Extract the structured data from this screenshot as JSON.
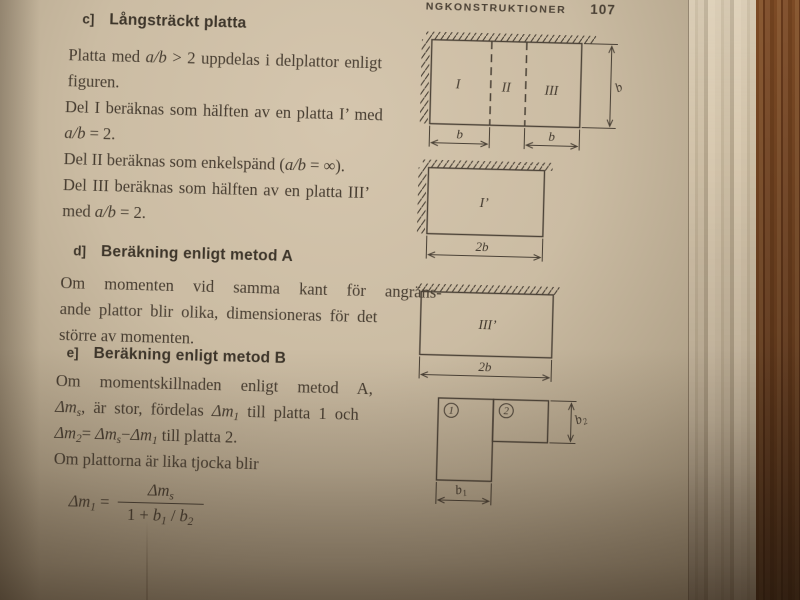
{
  "colors": {
    "paper": "#cbbca3",
    "ink": "#463c30",
    "wood": "#7c4a25"
  },
  "header": {
    "running_title_fragment": "NGKONSTRUKTIONER",
    "page_number": "107"
  },
  "content": {
    "section_c": {
      "label": "c]",
      "title": "Långsträckt platta"
    },
    "intro": {
      "l1": [
        {
          "s": "n",
          "t": "Platta med "
        },
        {
          "s": "i",
          "t": "a/b"
        },
        {
          "s": "n",
          "t": " > 2 uppdelas i delplattor enligt"
        }
      ],
      "l2": [
        {
          "s": "n",
          "t": "figuren."
        }
      ]
    },
    "del1": {
      "l1": [
        {
          "s": "n",
          "t": "Del I beräknas som hälften av en platta I’ med"
        }
      ],
      "l2": [
        {
          "s": "i",
          "t": "a/b"
        },
        {
          "s": "n",
          "t": " = 2."
        }
      ]
    },
    "del2": {
      "l1": [
        {
          "s": "n",
          "t": "Del II beräknas som enkelspänd ("
        },
        {
          "s": "i",
          "t": "a/b"
        },
        {
          "s": "n",
          "t": " = ∞)."
        }
      ]
    },
    "del3": {
      "l1": [
        {
          "s": "n",
          "t": "Del III beräknas som hälften av en platta III’"
        }
      ],
      "l2": [
        {
          "s": "n",
          "t": "med "
        },
        {
          "s": "i",
          "t": "a/b"
        },
        {
          "s": "n",
          "t": " = 2."
        }
      ]
    },
    "section_d": {
      "label": "d]",
      "title": "Beräkning enligt metod A"
    },
    "metodA": {
      "l1": [
        {
          "s": "n",
          "t": "Om momenten vid samma kant för angräns-"
        }
      ],
      "l2": [
        {
          "s": "n",
          "t": "ande plattor blir olika, dimensioneras för det"
        }
      ],
      "l3": [
        {
          "s": "n",
          "t": "större av momenten."
        }
      ]
    },
    "section_e": {
      "label": "e]",
      "title": "Beräkning enligt metod B"
    },
    "metodB": {
      "l1": [
        {
          "s": "n",
          "t": "Om momentskillnaden enligt metod A,"
        }
      ],
      "l2": [
        {
          "s": "i",
          "t": "Δm"
        },
        {
          "s": "sub",
          "t": "s"
        },
        {
          "s": "n",
          "t": ", är stor, fördelas "
        },
        {
          "s": "i",
          "t": "Δm"
        },
        {
          "s": "sub",
          "t": "1"
        },
        {
          "s": "n",
          "t": " till platta 1 och"
        }
      ],
      "l3": [
        {
          "s": "i",
          "t": "Δm"
        },
        {
          "s": "sub",
          "t": "2"
        },
        {
          "s": "n",
          "t": "= "
        },
        {
          "s": "i",
          "t": "Δm"
        },
        {
          "s": "sub",
          "t": "s"
        },
        {
          "s": "n",
          "t": "−"
        },
        {
          "s": "i",
          "t": "Δm"
        },
        {
          "s": "sub",
          "t": "1"
        },
        {
          "s": "n",
          "t": " till platta 2."
        }
      ],
      "l4": [
        {
          "s": "n",
          "t": "Om plattorna är lika tjocka blir"
        }
      ]
    },
    "formula": {
      "lhs": [
        {
          "s": "i",
          "t": "Δm"
        },
        {
          "s": "sub",
          "t": "1"
        },
        {
          "s": "n",
          "t": " ="
        }
      ],
      "numerator": [
        {
          "s": "i",
          "t": "Δm"
        },
        {
          "s": "sub",
          "t": "s"
        }
      ],
      "denominator": [
        {
          "s": "n",
          "t": "1 + "
        },
        {
          "s": "i",
          "t": "b"
        },
        {
          "s": "sub",
          "t": "1"
        },
        {
          "s": "n",
          "t": " / "
        },
        {
          "s": "i",
          "t": "b"
        },
        {
          "s": "sub",
          "t": "2"
        }
      ]
    }
  },
  "figures": {
    "fig1": {
      "part1": "I",
      "part2": "II",
      "part3": "III",
      "dim_right": "b",
      "dim_bottom_left": "b",
      "dim_bottom_right": "b"
    },
    "fig2": {
      "label": "I’",
      "dim_bottom": "2b"
    },
    "fig3": {
      "label": "III’",
      "dim_bottom": "2b"
    },
    "fig4": {
      "plate1": "1",
      "plate2": "2",
      "dim_b1_base": "b",
      "dim_b1_sub": "1",
      "dim_b2_base": "b",
      "dim_b2_sub": "2"
    }
  }
}
